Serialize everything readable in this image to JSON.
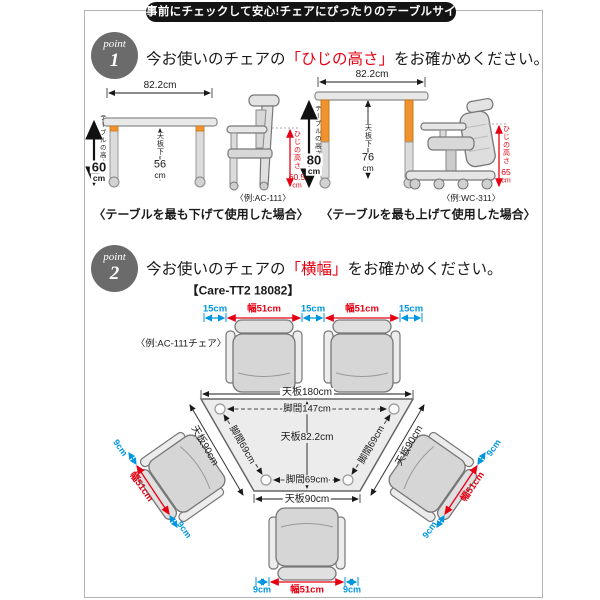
{
  "banner": "事前にチェックして安心!チェアにぴったりのテーブルサイズ",
  "colors": {
    "accent_red": "#e60012",
    "accent_blue": "#0096df",
    "leg_orange": "#f0922e",
    "banner_black": "#141414",
    "badge_gray": "#6b6b6b"
  },
  "point1": {
    "badge_word": "point",
    "badge_num": "1",
    "heading": {
      "prefix": "今お使いのチェアの",
      "highlight": "「ひじの高さ」",
      "suffix": "をお確かめください。"
    },
    "left": {
      "top_width": "82.2cm",
      "height_label": "テーブルの高さ",
      "height_value": "60",
      "height_unit": "cm",
      "under_label": "天板下",
      "under_value": "56",
      "under_unit": "cm",
      "elbow_label": "ひじの高さ",
      "elbow_value": "60.5",
      "elbow_unit": "cm",
      "example": "〈例:AC-111〉",
      "caption": "〈テーブルを最も下げて使用した場合〉"
    },
    "right": {
      "top_width": "82.2cm",
      "height_label": "テーブルの高さ",
      "height_value": "80",
      "height_unit": "cm",
      "under_label": "天板下",
      "under_value": "76",
      "under_unit": "cm",
      "elbow_label": "ひじの高さ",
      "elbow_value": "65",
      "elbow_unit": "cm",
      "example": "〈例:WC-311〉",
      "caption": "〈テーブルを最も上げて使用した場合〉"
    }
  },
  "point2": {
    "badge_word": "point",
    "badge_num": "2",
    "heading": {
      "prefix": "今お使いのチェアの",
      "highlight": "「横幅」",
      "suffix": "をお確かめください。"
    },
    "model": "【Care-TT2 18082】",
    "example": "〈例:AC-111チェア〉",
    "top_row": [
      "15cm",
      "幅51cm",
      "15cm",
      "幅51cm",
      "15cm"
    ],
    "table": {
      "top": "天板180cm",
      "legs_top": "脚間147cm",
      "depth": "天板82.2cm",
      "side_left": "天板90cm",
      "side_right": "天板90cm",
      "legs_side_left": "脚間69cm",
      "legs_side_right": "脚間69cm",
      "legs_bottom": "脚間69cm",
      "bottom": "天板90cm"
    },
    "left_chair": {
      "gap_top": "9cm",
      "width": "幅51cm",
      "gap_bottom": "9cm"
    },
    "right_chair": {
      "gap_top": "9cm",
      "width": "幅51cm",
      "gap_bottom": "9cm"
    },
    "bottom_chair": {
      "gap_left": "9cm",
      "width": "幅51cm",
      "gap_right": "9cm"
    }
  }
}
